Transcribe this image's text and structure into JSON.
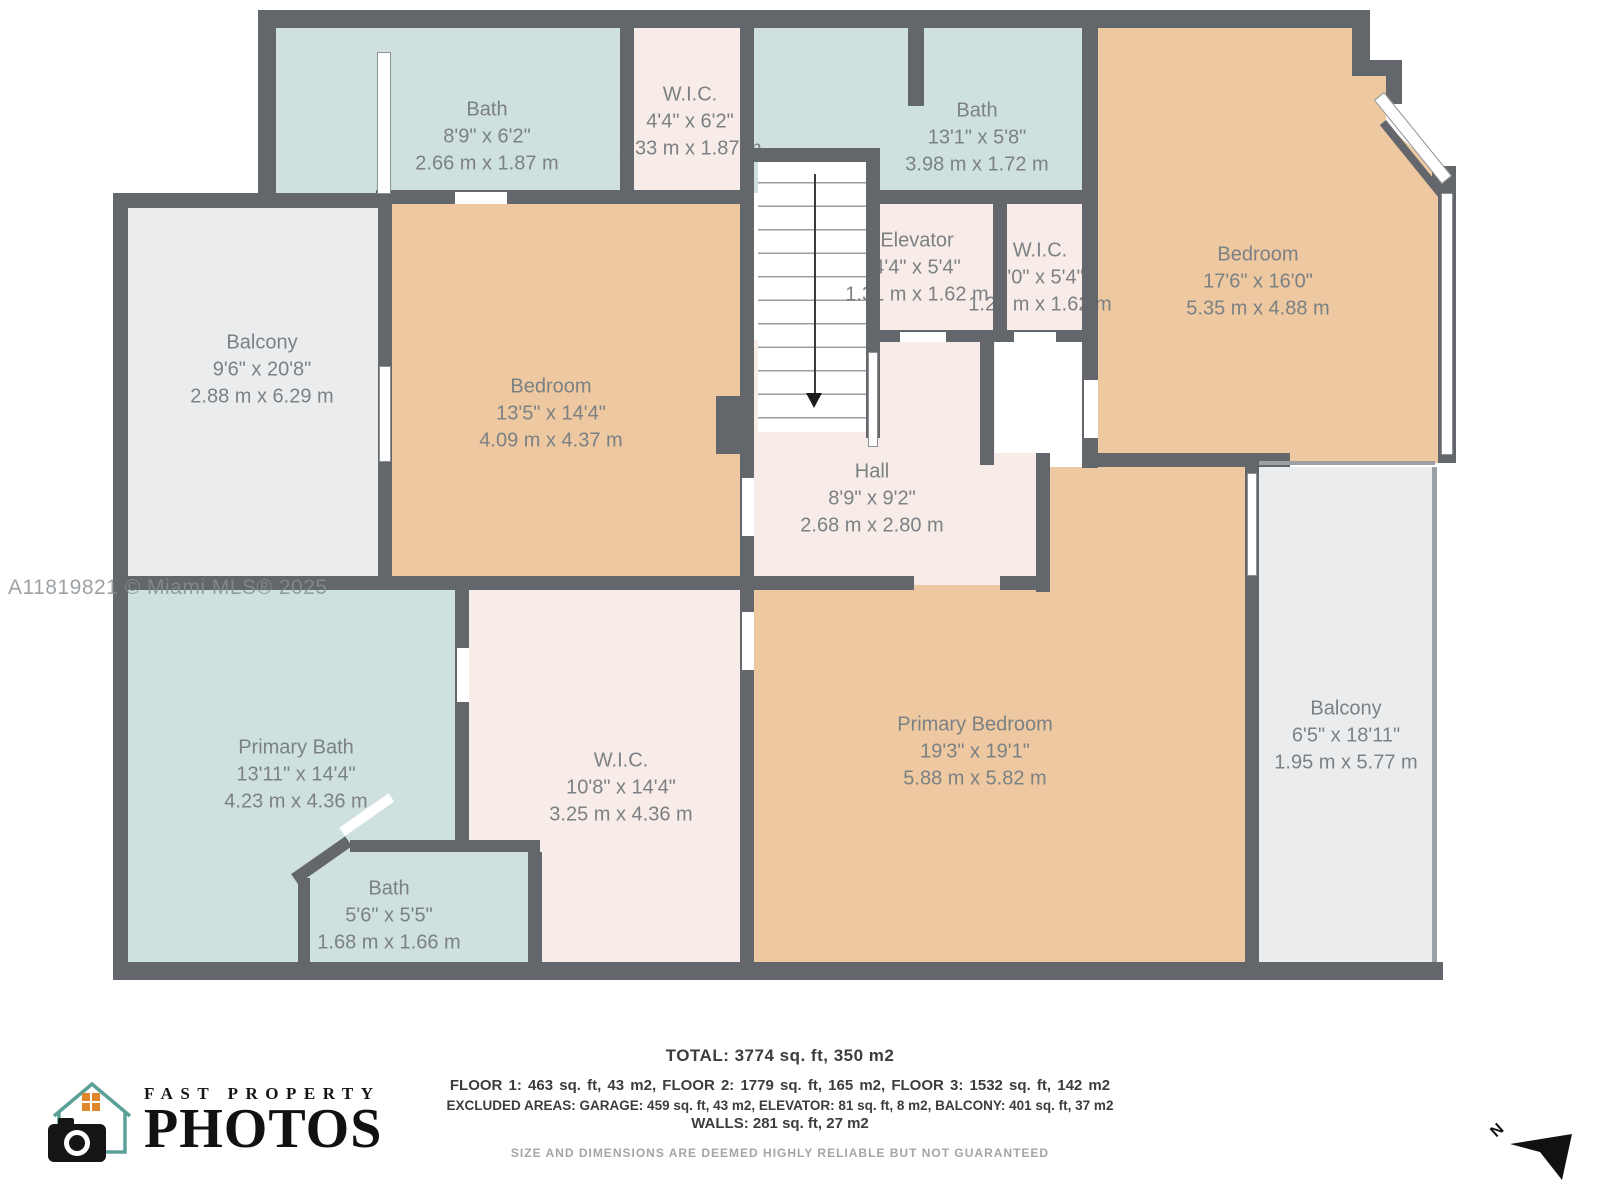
{
  "watermark": "A11819821 © Miami MLS® 2025",
  "colors": {
    "wall": "#63666a",
    "bath_fill": "#cfe0e1",
    "bedroom_fill": "#edc8a1",
    "closet_hall_fill": "#f7ece7",
    "balcony_fill": "#ebeced",
    "label_text": "#7c8184",
    "logo_house": "#5ba096",
    "logo_window": "#e0862c"
  },
  "rooms": [
    {
      "name": "Bath",
      "imperial": "8'9\" x 6'2\"",
      "metric": "2.66 m x 1.87 m"
    },
    {
      "name": "W.I.C.",
      "imperial": "4'4\" x 6'2\"",
      "metric": "1.33 m x 1.87 m"
    },
    {
      "name": "Bath",
      "imperial": "13'1\" x 5'8\"",
      "metric": "3.98 m x 1.72 m"
    },
    {
      "name": "Bedroom",
      "imperial": "17'6\" x 16'0\"",
      "metric": "5.35 m x 4.88 m"
    },
    {
      "name": "Balcony",
      "imperial": "9'6\" x 20'8\"",
      "metric": "2.88 m x 6.29 m"
    },
    {
      "name": "Bedroom",
      "imperial": "13'5\" x 14'4\"",
      "metric": "4.09 m x 4.37 m"
    },
    {
      "name": "Elevator",
      "imperial": "4'4\" x 5'4\"",
      "metric": "1.31 m x 1.62 m"
    },
    {
      "name": "W.I.C.",
      "imperial": "4'0\" x 5'4\"",
      "metric": "1.21 m x 1.62 m"
    },
    {
      "name": "Hall",
      "imperial": "8'9\" x 9'2\"",
      "metric": "2.68 m x 2.80 m"
    },
    {
      "name": "Primary Bath",
      "imperial": "13'11\" x 14'4\"",
      "metric": "4.23 m x 4.36 m"
    },
    {
      "name": "W.I.C.",
      "imperial": "10'8\" x 14'4\"",
      "metric": "3.25 m x 4.36 m"
    },
    {
      "name": "Primary Bedroom",
      "imperial": "19'3\" x 19'1\"",
      "metric": "5.88 m x 5.82 m"
    },
    {
      "name": "Balcony",
      "imperial": "6'5\" x 18'11\"",
      "metric": "1.95 m x 5.77 m"
    },
    {
      "name": "Bath",
      "imperial": "5'6\" x 5'5\"",
      "metric": "1.68 m x 1.66 m"
    }
  ],
  "footer": {
    "total": "TOTAL: 3774 sq. ft, 350 m2",
    "floors": "FLOOR 1: 463 sq. ft, 43 m2, FLOOR 2: 1779 sq. ft, 165 m2, FLOOR 3: 1532 sq. ft, 142 m2",
    "excluded": "EXCLUDED AREAS: GARAGE: 459 sq. ft, 43 m2, ELEVATOR: 81 sq. ft, 8 m2, BALCONY: 401 sq. ft, 37 m2",
    "walls": "WALLS: 281 sq. ft, 27 m2",
    "disclaimer": "SIZE AND DIMENSIONS ARE DEEMED HIGHLY RELIABLE BUT NOT GUARANTEED"
  },
  "logo": {
    "line1": "FAST PROPERTY",
    "line2": "PHOTOS"
  },
  "compass": {
    "label": "N"
  }
}
